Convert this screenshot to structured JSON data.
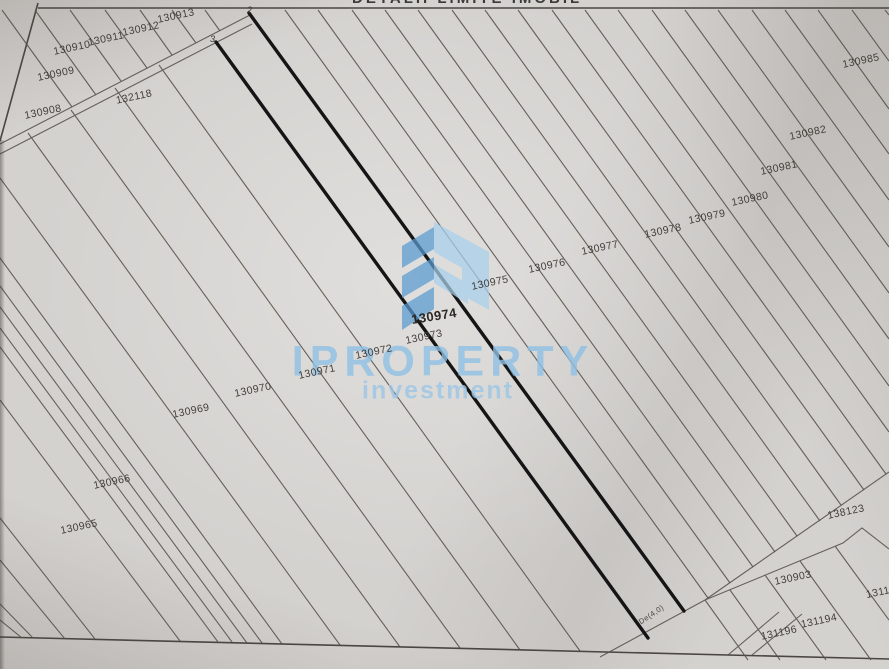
{
  "header": {
    "title": "DETALII LIMITE IMOBIL"
  },
  "watermark": {
    "brand": "IPROPERTY",
    "subtitle": "investment",
    "logo_icon": "iproperty-chevron-logo",
    "color_dark": "#5a9bd2",
    "color_light": "#a9d0ec"
  },
  "map": {
    "highlighted_parcel": "130974",
    "road_label": "De(4,0)",
    "vertex_2": "2",
    "vertex_3": "3",
    "line_color": "#56504b",
    "bold_line_color": "#151515",
    "parcels": [
      {
        "id": "130913",
        "x": 176,
        "y": 16
      },
      {
        "id": "130912",
        "x": 141,
        "y": 29
      },
      {
        "id": "130911",
        "x": 106,
        "y": 39
      },
      {
        "id": "130910",
        "x": 72,
        "y": 48
      },
      {
        "id": "130909",
        "x": 56,
        "y": 74
      },
      {
        "id": "130908",
        "x": 43,
        "y": 112
      },
      {
        "id": "132118",
        "x": 134,
        "y": 97
      },
      {
        "id": "130965",
        "x": 79,
        "y": 527
      },
      {
        "id": "130966",
        "x": 112,
        "y": 482
      },
      {
        "id": "130969",
        "x": 191,
        "y": 411
      },
      {
        "id": "130970",
        "x": 253,
        "y": 390
      },
      {
        "id": "130971",
        "x": 317,
        "y": 372
      },
      {
        "id": "130972",
        "x": 374,
        "y": 352
      },
      {
        "id": "130973",
        "x": 424,
        "y": 337
      },
      {
        "id": "130974",
        "x": 434,
        "y": 316,
        "bold": true
      },
      {
        "id": "130975",
        "x": 490,
        "y": 283
      },
      {
        "id": "130976",
        "x": 547,
        "y": 266
      },
      {
        "id": "130977",
        "x": 600,
        "y": 248
      },
      {
        "id": "130978",
        "x": 663,
        "y": 231
      },
      {
        "id": "130979",
        "x": 707,
        "y": 217
      },
      {
        "id": "130980",
        "x": 750,
        "y": 199
      },
      {
        "id": "130981",
        "x": 779,
        "y": 168
      },
      {
        "id": "130982",
        "x": 808,
        "y": 133
      },
      {
        "id": "130985",
        "x": 861,
        "y": 61
      },
      {
        "id": "138123",
        "x": 846,
        "y": 512
      },
      {
        "id": "130903",
        "x": 793,
        "y": 578
      },
      {
        "id": "13117",
        "x": 881,
        "y": 592
      },
      {
        "id": "131194",
        "x": 819,
        "y": 621
      },
      {
        "id": "131196",
        "x": 779,
        "y": 633
      }
    ]
  }
}
